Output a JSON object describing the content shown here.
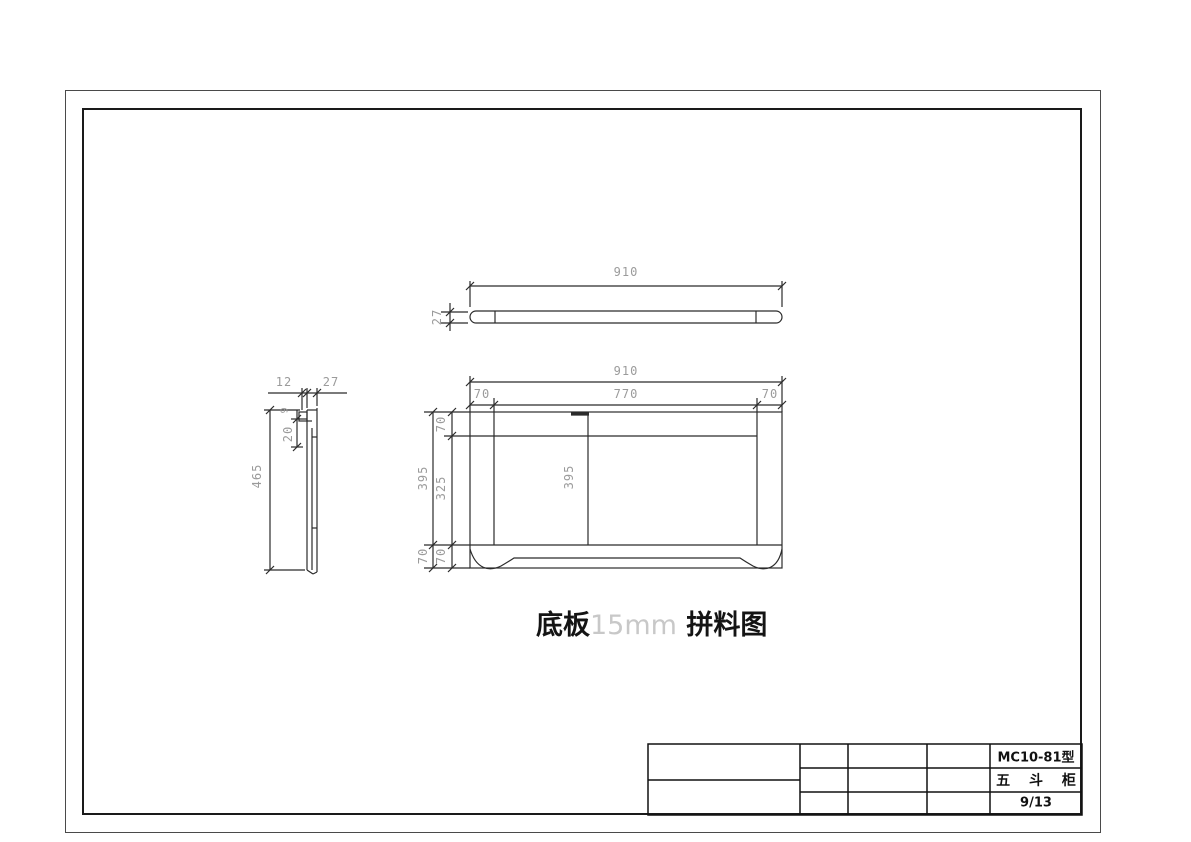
{
  "drawing_title": {
    "part_name": "底板",
    "thickness": "15mm",
    "type_label": " 拼料图"
  },
  "title_block": {
    "model": "MC10-81型",
    "product_name": "五 斗 柜",
    "sheet": "9/13"
  },
  "views": {
    "top_view": {
      "dims": {
        "length": "910",
        "thickness": "27"
      }
    },
    "side_view": {
      "dims": {
        "edge": "12",
        "thickness": "27",
        "height": "465",
        "offset": "20",
        "notch": "9"
      }
    },
    "front_view": {
      "dims": {
        "total_width": "910",
        "left_leg": "70",
        "middle_span": "770",
        "right_leg": "70",
        "height_outer": "395",
        "top_rail": "70",
        "opening": "325",
        "bottom_rail_outer": "70",
        "bottom_rail_inner": "70",
        "center_height": "395"
      }
    }
  },
  "colors": {
    "line": "#2b2b2b",
    "dim_text": "#9b9b9b",
    "light_text": "#c8c8c8",
    "title_text": "#141414"
  }
}
